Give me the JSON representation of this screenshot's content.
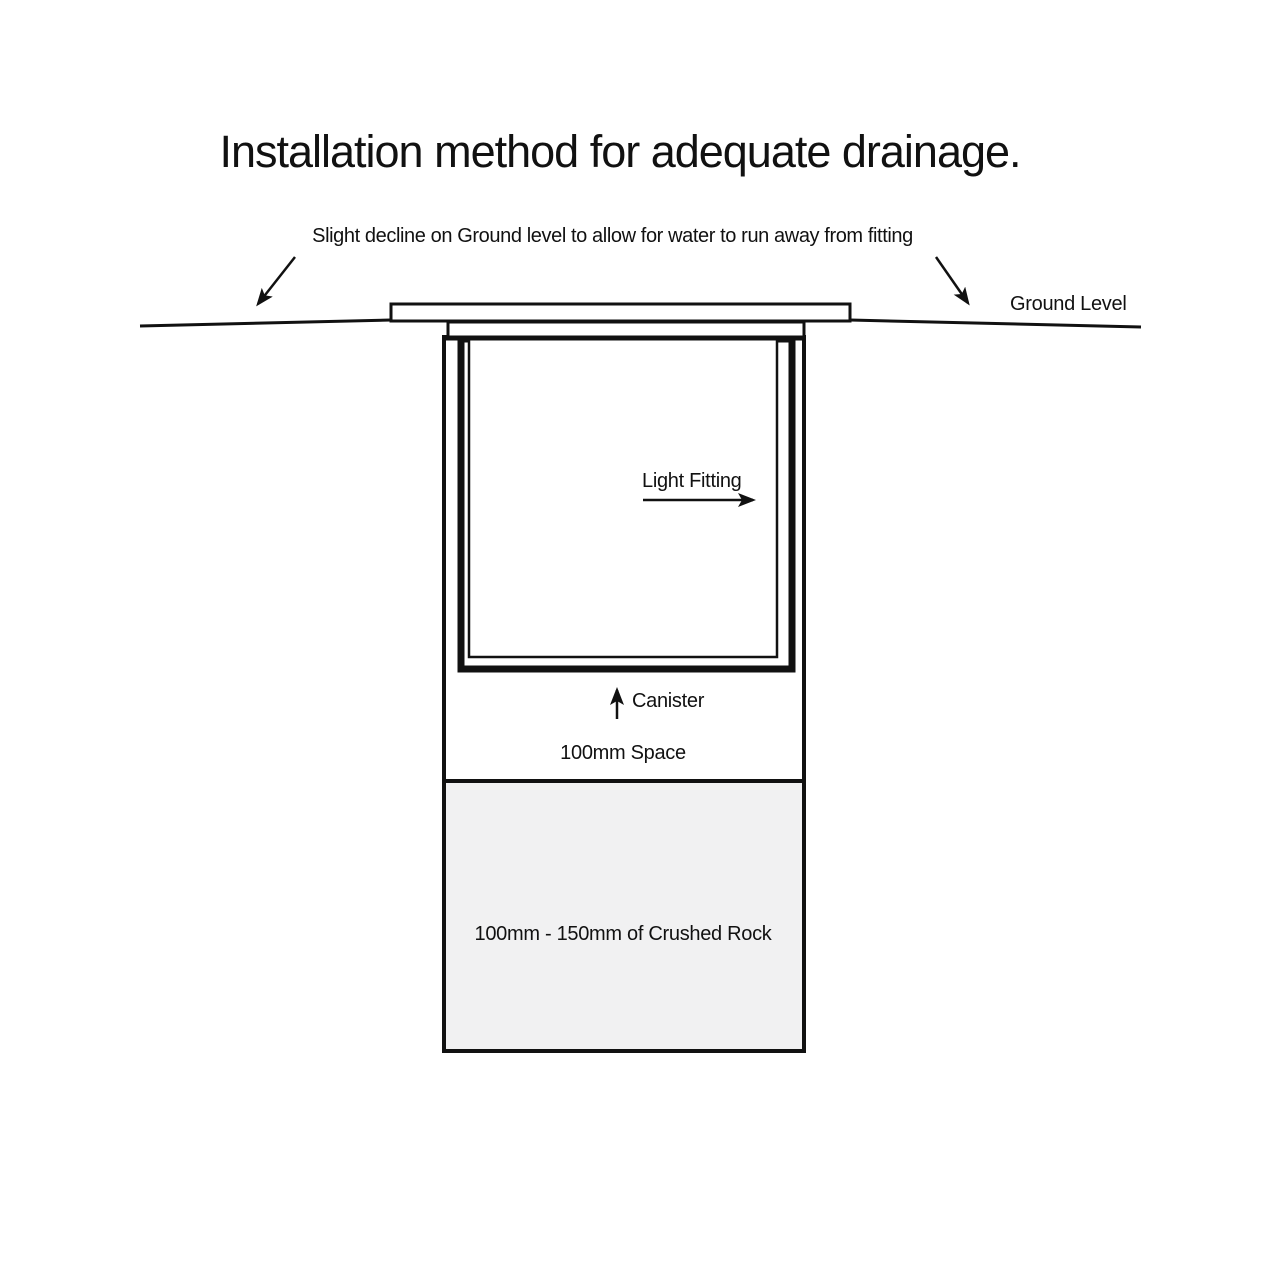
{
  "title": "Installation method for adequate drainage.",
  "labels": {
    "decline_note": "Slight decline on Ground level to allow for water to run away from fitting",
    "ground_level": "Ground Level",
    "light_fitting": "Light Fitting",
    "canister": "Canister",
    "space": "100mm Space",
    "crushed_rock": "100mm - 150mm of Crushed Rock"
  },
  "colors": {
    "line": "#111111",
    "background": "#ffffff",
    "crushed_rock_fill": "#f1f1f2"
  }
}
